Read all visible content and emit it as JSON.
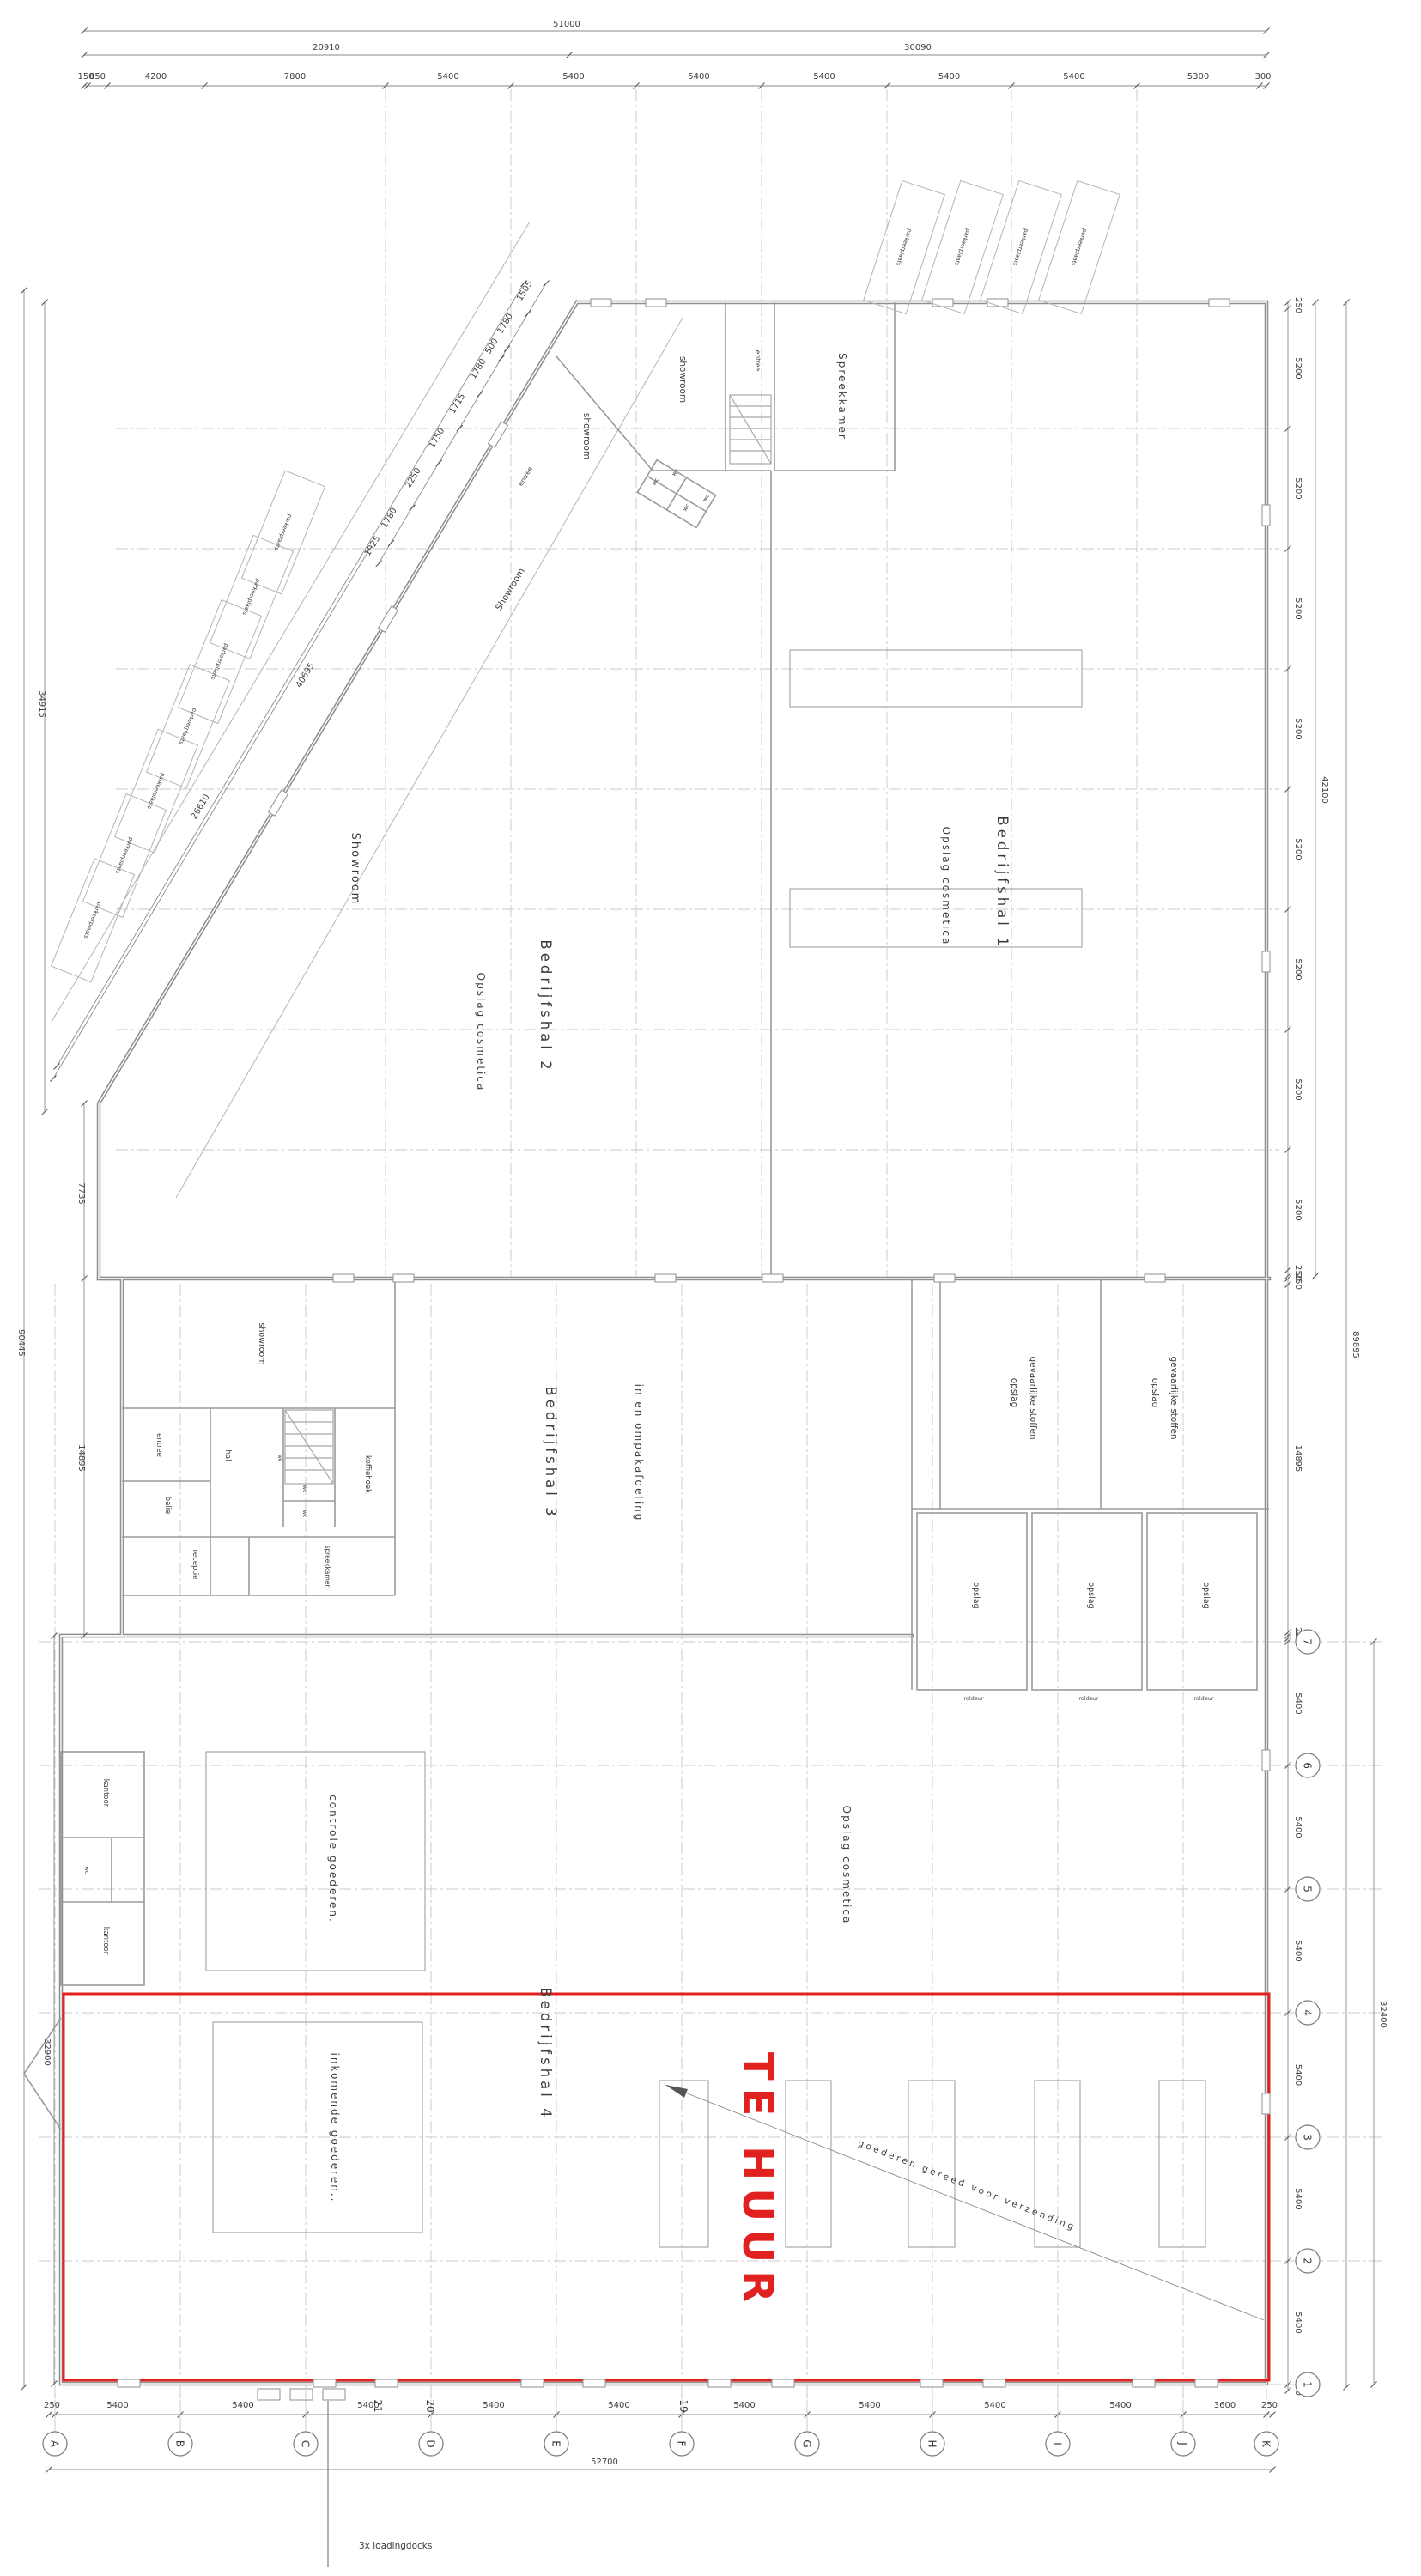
{
  "title": "plattegrond bedrijfscomplex",
  "colors": {
    "highlight_red": "#e0211f",
    "wall_gray": "#8f8f8f",
    "text_gray": "#3c3c3c"
  },
  "dims": {
    "top": {
      "overall": "51000",
      "left_total": "20910",
      "right_total": "30090",
      "segments": [
        "150",
        "850",
        "4200",
        "7800",
        "5400",
        "5400",
        "5400",
        "5400",
        "5400",
        "5400",
        "5300",
        "300"
      ]
    },
    "right_upper": {
      "segments": [
        "250",
        "5200",
        "5200",
        "5200",
        "5200",
        "5200",
        "5200",
        "5200",
        "5200",
        "250"
      ],
      "total": "42100",
      "overall": "89895"
    },
    "right_middle": {
      "segments": [
        "250",
        "14895",
        "250"
      ]
    },
    "right_lower": {
      "segments": [
        "250",
        "5400",
        "5400",
        "5400",
        "5400",
        "5400",
        "5400",
        "250"
      ],
      "total": "32400"
    },
    "bottom": {
      "segments": [
        "250",
        "5400",
        "5400",
        "5400",
        "5400",
        "5400",
        "5400",
        "5400",
        "5400",
        "5400",
        "3600",
        "250"
      ],
      "total": "52700"
    },
    "left": {
      "upper": "34915",
      "mid": "7735",
      "hal3": "14895",
      "hal4": "32900",
      "overall": "90445"
    },
    "diagonal_chain": [
      "1505",
      "1780",
      "500",
      "1780",
      "1715",
      "1750",
      "2250",
      "1780",
      "1025"
    ],
    "diagonal_total_a": "40695",
    "diagonal_total_b": "26610"
  },
  "grid": {
    "columns": [
      "A",
      "B",
      "C",
      "D",
      "E",
      "F",
      "G",
      "H",
      "I",
      "J",
      "K"
    ],
    "rows": [
      "7",
      "6",
      "5",
      "4",
      "3",
      "2",
      "1"
    ]
  },
  "halls": {
    "hal1": {
      "name": "Bedrijfshal 1",
      "use": "Opslag cosmetica"
    },
    "hal2": {
      "name": "Bedrijfshal 2",
      "use": "Opslag cosmetica"
    },
    "hal3": {
      "name": "Bedrijfshal 3",
      "use": "in en ompakafdeling"
    },
    "hal4": {
      "name": "Bedrijfshal 4",
      "use": "Opslag cosmetica"
    }
  },
  "rooms": {
    "showroom_strip": "Showroom",
    "showroom_diag": "Showroom",
    "showroom_a": "showroom",
    "showroom_b": "showroom",
    "spreekkamer": "Spreekkamer",
    "entree": "entree",
    "entree_diag": "entree",
    "showroom_office": "showroom",
    "entree_office": "entree",
    "hal": "hal",
    "wk": "wk",
    "wc": "wc",
    "koffiehoek": "koffiehoek",
    "balie": "balie",
    "receptie": "receptie",
    "spreekkamer_office": "spreekkamer",
    "kantoor": "kantoor",
    "opslag": "opslag",
    "roldeur": "roldeur",
    "gevaarlijk_line1": "opslag",
    "gevaarlijk_line2": "gevaarlijke stoffen",
    "controle": "controle  goederen.",
    "inkomende": "inkomende  goederen..",
    "parkeerplaats": "parkeerplaats"
  },
  "annotations": {
    "te_huur": "TE HUUR",
    "loadingdocks": "3x  loadingdocks",
    "verzending": "goederen  gereed  voor  verzending",
    "door_numbers": [
      "21",
      "20",
      "19"
    ]
  }
}
